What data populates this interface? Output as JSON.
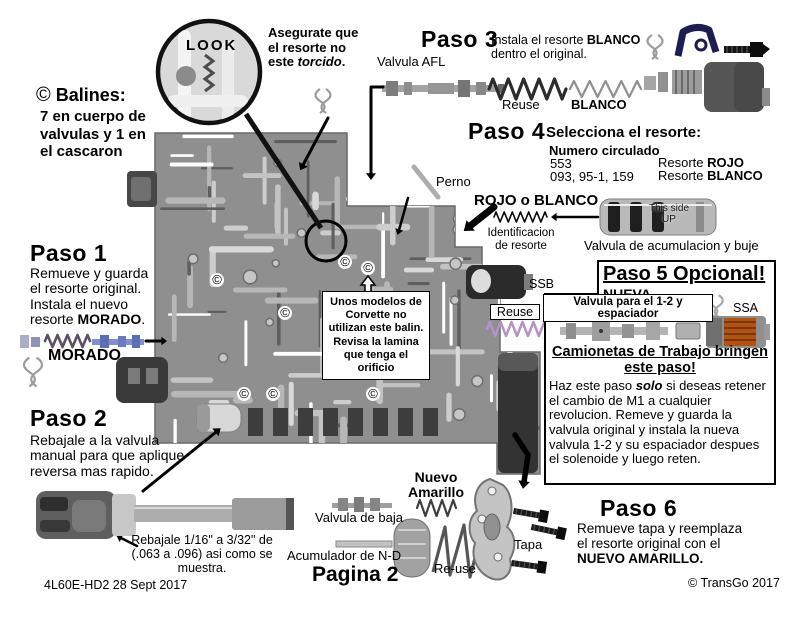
{
  "colors": {
    "body_gray": "#8f8f8f",
    "purple_spring": "#b493c8",
    "navy_clip": "#1d1d52",
    "ssa_coil": "#b25310",
    "morado_blue": "#7f8fd0"
  },
  "magnifier": {
    "label": "LOOK",
    "note_pre": "Asegurate que\nel resorte no\neste ",
    "note_italic": "torcido",
    "note_post": "."
  },
  "balines": {
    "symbol": "©",
    "title": "Balines:",
    "body": "7 en cuerpo de\nvalvulas y 1 en\nel cascaron",
    "marker": "©"
  },
  "paso1": {
    "title": "Paso 1",
    "body_pre": "Remueve y guarda\nel resorte original.\nInstala el nuevo\nresorte ",
    "body_bold": "MORADO",
    "body_post": ".",
    "part_label": "MORADO"
  },
  "paso2": {
    "title": "Paso 2",
    "body": "Rebajale a la valvula\nmanual para que aplique\nreversa mas rapido.",
    "valve_note": "Rebajale 1/16\" a 3/32\" de\n(.063 a .096) asi como se\nmuestra."
  },
  "paso3": {
    "title": "Paso 3",
    "body_pre": "Instala el resorte ",
    "body_bold": "BLANCO",
    "body_post": "\ndentro el original.",
    "valve_label": "Valvula AFL",
    "spring_reuse": "Reuse",
    "spring_blanco": "BLANCO"
  },
  "paso4": {
    "title": "Paso 4",
    "subtitle": "Selecciona el resorte:",
    "col_header": "Numero circulado",
    "rows": [
      {
        "num": "553",
        "pre": "Resorte ",
        "bold": "ROJO"
      },
      {
        "num": "093, 95-1, 159",
        "pre": "Resorte ",
        "bold": "BLANCO"
      }
    ],
    "rojo_blanco": "ROJO o BLANCO",
    "id_label": "Identificacion\nde resorte",
    "perno": "Perno",
    "this_side": "This side\nUP",
    "acum_label": "Valvula de acumulacion y buje"
  },
  "paso5": {
    "title": "Paso 5 Opcional!",
    "nueva": "NUEVA",
    "valve_label": "Valvula para el 1-2 y espaciador",
    "ssa": "SSA",
    "ssb": "SSB",
    "reuse": "Reuse",
    "subtitle": "Camionetas de Trabajo bringen\neste paso!",
    "body_pre": "Haz este paso ",
    "body_bold": "solo",
    "body_post": " si deseas retener el cambio de M1 a cualquier revolucion. Remeve y guarda la valvula original y instala la nueva valvula 1-2 y su espaciador despues el solenoide y luego reten."
  },
  "paso6": {
    "title": "Paso 6",
    "body_pre": "Remueve tapa y reemplaza\nel resorte original con el\n",
    "body_bold": "NUEVO AMARILLO.",
    "tapa": "Tapa",
    "nuevo_amarillo": "Nuevo\nAmarillo",
    "reuse": "Re-use"
  },
  "bottom": {
    "valvula_baja": "Valvula de baja",
    "acumulador_nd": "Acumulador de N-D",
    "pagina": "Pagina 2"
  },
  "note_box": {
    "text": "Unos modelos\nde Corvette no\nutilizan este balin.\nRevisa la lamina\nque tenga el\norificio"
  },
  "footer": {
    "left": "4L60E-HD2  28 Sept 2017",
    "right": "© TransGo 2017"
  }
}
